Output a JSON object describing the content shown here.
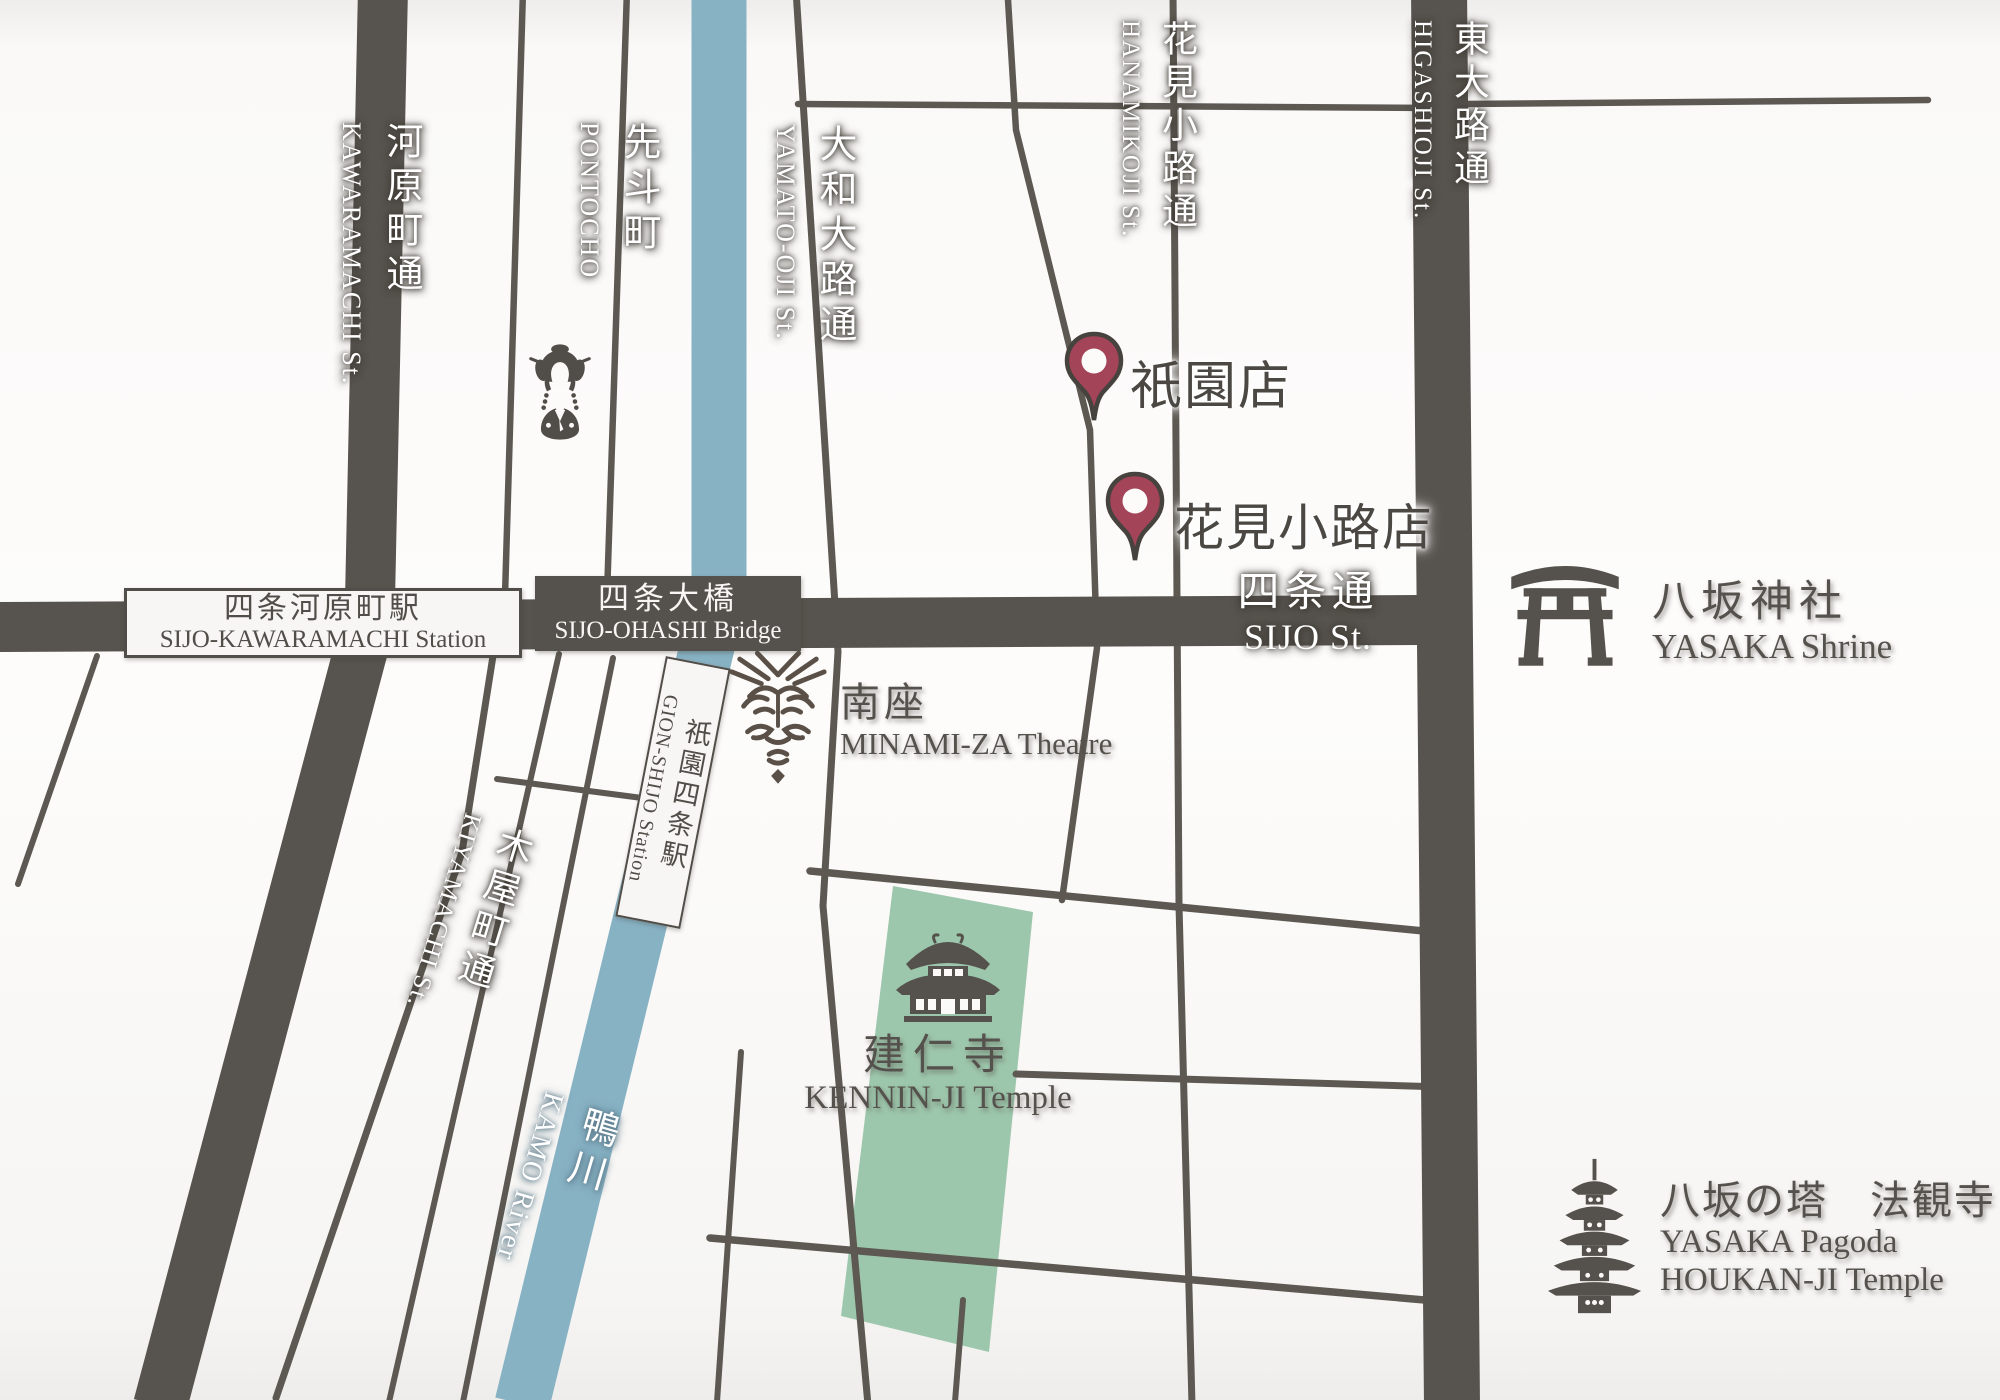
{
  "streets": {
    "kawaramachi": {
      "jp": "河原町通",
      "en": "KAWARAMACHI St."
    },
    "pontocho": {
      "jp": "先斗町",
      "en": "PONTOCHO"
    },
    "yamatooji": {
      "jp": "大和大路通",
      "en": "YAMATO-OJI St."
    },
    "hanamikoji": {
      "jp": "花見小路通",
      "en": "HANAMIKOJI St."
    },
    "higashioji": {
      "jp": "東大路通",
      "en": "HIGASHIOJI St."
    },
    "kiyamachi": {
      "jp": "木屋町通",
      "en": "KIYAMACHI St."
    },
    "sijo": {
      "jp": "四条通",
      "en": "SIJO St."
    }
  },
  "river": {
    "jp": "鴨川",
    "en": "KAMO River"
  },
  "stations": {
    "sijo_kawaramachi": {
      "jp": "四条河原町駅",
      "en": "SIJO-KAWARAMACHI Station"
    },
    "sijo_ohashi": {
      "jp": "四条大橋",
      "en": "SIJO-OHASHI Bridge"
    },
    "gion_shijo": {
      "jp": "祇園四条駅",
      "en": "GION-SHIJO Station"
    }
  },
  "landmarks": {
    "minamiza": {
      "jp": "南座",
      "en": "MINAMI-ZA Theatre",
      "icon": "kabuki-mask-icon"
    },
    "yasaka_shrine": {
      "jp": "八坂神社",
      "en": "YASAKA Shrine",
      "icon": "torii-icon"
    },
    "kenninji": {
      "jp": "建仁寺",
      "en": "KENNIN-JI Temple",
      "icon": "temple-icon"
    },
    "yasaka_pagoda": {
      "jp": "八坂の塔　法観寺",
      "en_line1": "YASAKA Pagoda",
      "en_line2": "HOUKAN-JI Temple",
      "icon": "pagoda-icon"
    }
  },
  "pins": {
    "gion": {
      "label": "祇園店"
    },
    "hanamikoji": {
      "label": "花見小路店"
    }
  },
  "decorative_icons": {
    "maiko": "maiko-icon"
  },
  "colors": {
    "road": "#57534e",
    "road_thin": "#5d5952",
    "river": "#87b2c4",
    "temple_area": "#9dc7ac",
    "pin": "#a34459",
    "pin_outline": "#46423d",
    "pin_center": "#fcfbfa",
    "ink": "#55514c",
    "background": "#fbfaf9"
  }
}
